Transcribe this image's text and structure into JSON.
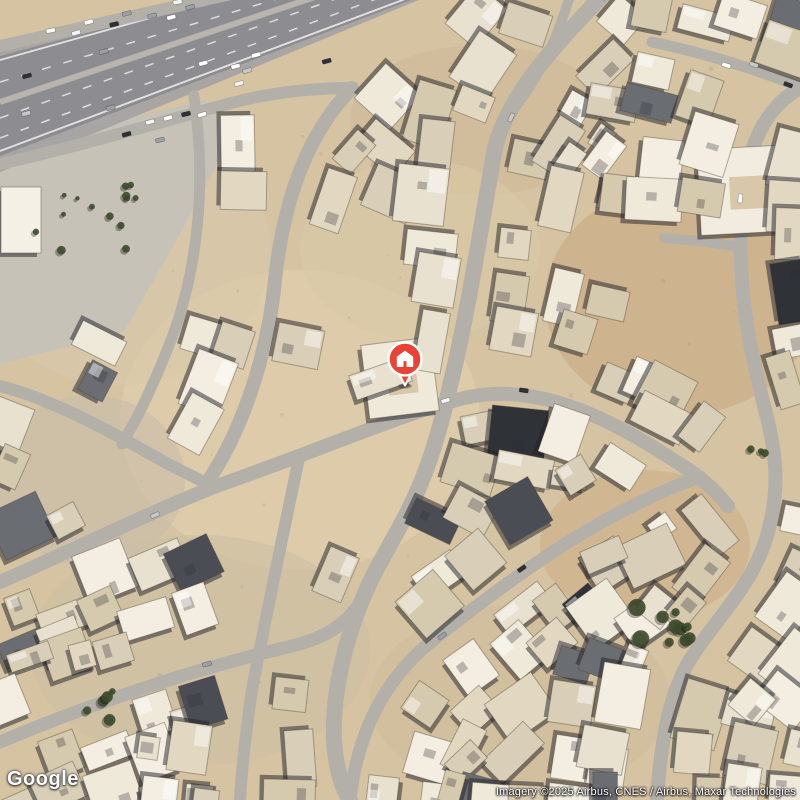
{
  "map": {
    "description": "Satellite imagery of a desert suburb with curvilinear streets, flat-roofed compounds and a divided highway crossing the top-left corner",
    "marker": {
      "icon": "home-pin-icon",
      "x": 405,
      "y": 359,
      "color": "#EA4335",
      "ring": "#ffffff"
    },
    "colors": {
      "sand": "#d5c3a2",
      "road": "#b3b0a9",
      "asphalt": "#8d8c90",
      "shoulder": "#a3a2a2",
      "plaza": "#c7c2b7",
      "building_shadow": "rgba(32,32,40,0.5)",
      "vegetation": "#3c4a2c",
      "building_palette": [
        "#efe9da",
        "#e8e1cf",
        "#e2d8c2",
        "#d9cfb8",
        "#f3eee1",
        "#d5c9ae"
      ],
      "dark_roofs": [
        "#6a6e73",
        "#4a4e54",
        "#2f3237"
      ],
      "car_palette": [
        "#ffffff",
        "#f4f4f4",
        "#2e3135",
        "#c8c9cb",
        "#9aa0a6"
      ]
    },
    "highway": {
      "shoulder": "0,40 250,-12 448,-12 0,172",
      "asphalt": "0,56 240,-8 432,-8 0,156",
      "median": [
        0,
        102,
        330,
        -8
      ],
      "lanes": [
        [
          0,
          82,
          300,
          -8
        ],
        [
          0,
          118,
          355,
          -8
        ],
        [
          0,
          138,
          395,
          -8
        ]
      ],
      "edges": [
        [
          0,
          60,
          243,
          -8
        ],
        [
          0,
          151,
          424,
          -8
        ]
      ],
      "axis": [
        [
          0,
          104
        ],
        [
          436,
          -10
        ]
      ]
    },
    "plaza_polygon": [
      [
        0,
        148
      ],
      [
        205,
        100
      ],
      [
        232,
        136
      ],
      [
        178,
        238
      ],
      [
        124,
        332
      ],
      [
        0,
        364
      ]
    ],
    "roads": [
      {
        "name": "frontage-north",
        "d": "M 0,46 L 240,-8",
        "w": 12
      },
      {
        "name": "frontage-south",
        "d": "M 0,164 C 80,146 160,122 235,102 C 275,92 315,88 352,88",
        "w": 12
      },
      {
        "name": "inner-loop-west",
        "d": "M 194,96 C 206,180 200,268 168,348 C 154,383 140,414 122,444",
        "w": 11
      },
      {
        "name": "arc-street-1",
        "d": "M 352,88 C 305,136 283,205 275,280 C 269,345 246,426 206,484",
        "w": 14
      },
      {
        "name": "west-branch-upper",
        "d": "M 0,386 C 56,400 122,438 168,464 C 186,473 200,480 214,487",
        "w": 12
      },
      {
        "name": "west-branch-lower",
        "d": "M 0,582 C 76,549 148,513 214,487",
        "w": 14
      },
      {
        "name": "cross-arc-central",
        "d": "M 214,487 C 330,446 402,414 464,398 C 545,379 625,428 686,468 C 706,481 718,494 728,506",
        "w": 14
      },
      {
        "name": "main-arc-street",
        "d": "M 604,-6 C 562,38 509,92 495,148 C 481,225 469,310 449,390 C 426,492 402,520 374,574 C 347,628 332,690 334,740 C 336,770 342,788 350,800",
        "w": 16
      },
      {
        "name": "east-arc-street",
        "d": "M 800,88 C 757,112 744,162 741,218 C 738,292 749,344 763,402 C 777,452 779,486 770,524 C 759,577 722,612 695,652 C 671,686 661,736 657,800",
        "w": 14
      },
      {
        "name": "south-diagonal",
        "d": "M 350,800 C 357,736 382,681 432,641 C 482,601 523,571 562,546 C 612,514 662,490 700,477",
        "w": 13
      },
      {
        "name": "southwest-arc",
        "d": "M 0,742 C 95,702 198,668 292,646 C 330,637 352,620 368,590",
        "w": 13
      },
      {
        "name": "northeast-connector",
        "d": "M 652,42 C 700,52 752,68 798,86",
        "w": 11
      },
      {
        "name": "east-connector",
        "d": "M 664,238 C 690,240 716,243 741,247",
        "w": 10
      },
      {
        "name": "south-connector",
        "d": "M 299,458 C 284,530 267,610 252,690 C 246,730 242,764 240,800",
        "w": 12
      },
      {
        "name": "north-connector",
        "d": "M 570,-4 C 558,34 544,68 522,98 C 510,115 501,130 495,143",
        "w": 10
      }
    ]
  },
  "branding": {
    "logo": "Google"
  },
  "attribution": {
    "text": "Imagery ©2025 Airbus, CNES / Airbus, Maxar Technologies"
  }
}
